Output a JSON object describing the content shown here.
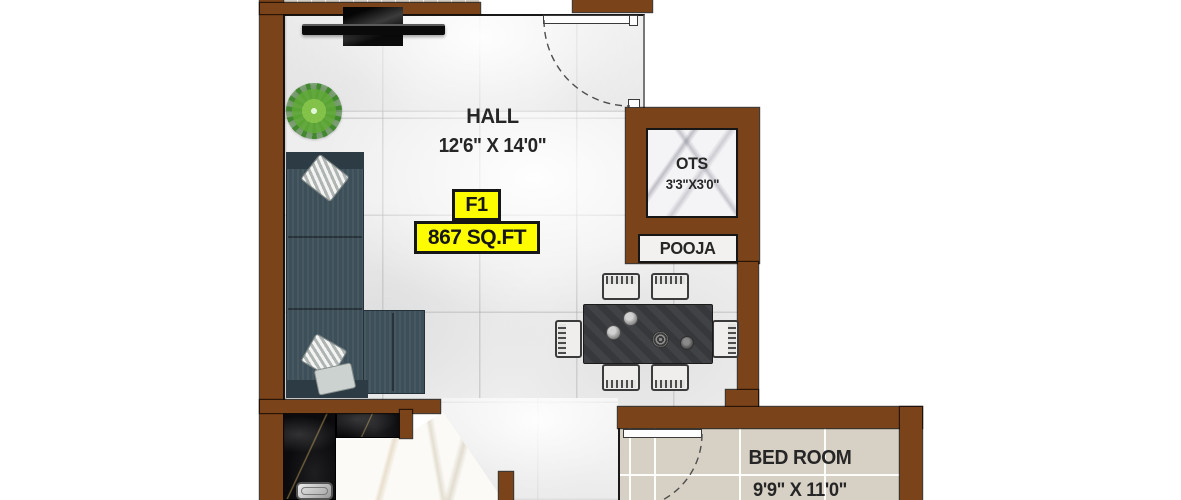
{
  "unit": {
    "flat": "F1",
    "area": "867 SQ.FT"
  },
  "rooms": {
    "hall": {
      "name": "HALL",
      "dims": "12'6\" X 14'0\""
    },
    "ots": {
      "name": "OTS",
      "dims": "3'3\"X3'0\""
    },
    "pooja": {
      "name": "POOJA"
    },
    "bedroom": {
      "name": "BED ROOM",
      "dims": "9'9\" X 11'0\""
    }
  },
  "colors": {
    "wall_brown": "#7b431a",
    "badge_yellow": "#fdfd00",
    "outline_black": "#161616",
    "hall_tile": "#eeeeee",
    "bedroom_tile": "#d7d0c5",
    "sofa_slate": "#3d4f59",
    "table_charcoal": "#36383b",
    "counter_black_marble": "#0b0b0d",
    "ots_white_marble": "#f4f4f6"
  },
  "furniture_icons": {
    "tv": "wall-mounted-tv-icon",
    "plant": "potted-plant-icon",
    "sofa": "l-shaped-sofa-icon",
    "dining_table": "six-seater-dining-table-icon",
    "sink": "kitchen-sink-icon",
    "main_door": "door-swing-arc-icon",
    "bedroom_door": "door-swing-arc-icon"
  }
}
